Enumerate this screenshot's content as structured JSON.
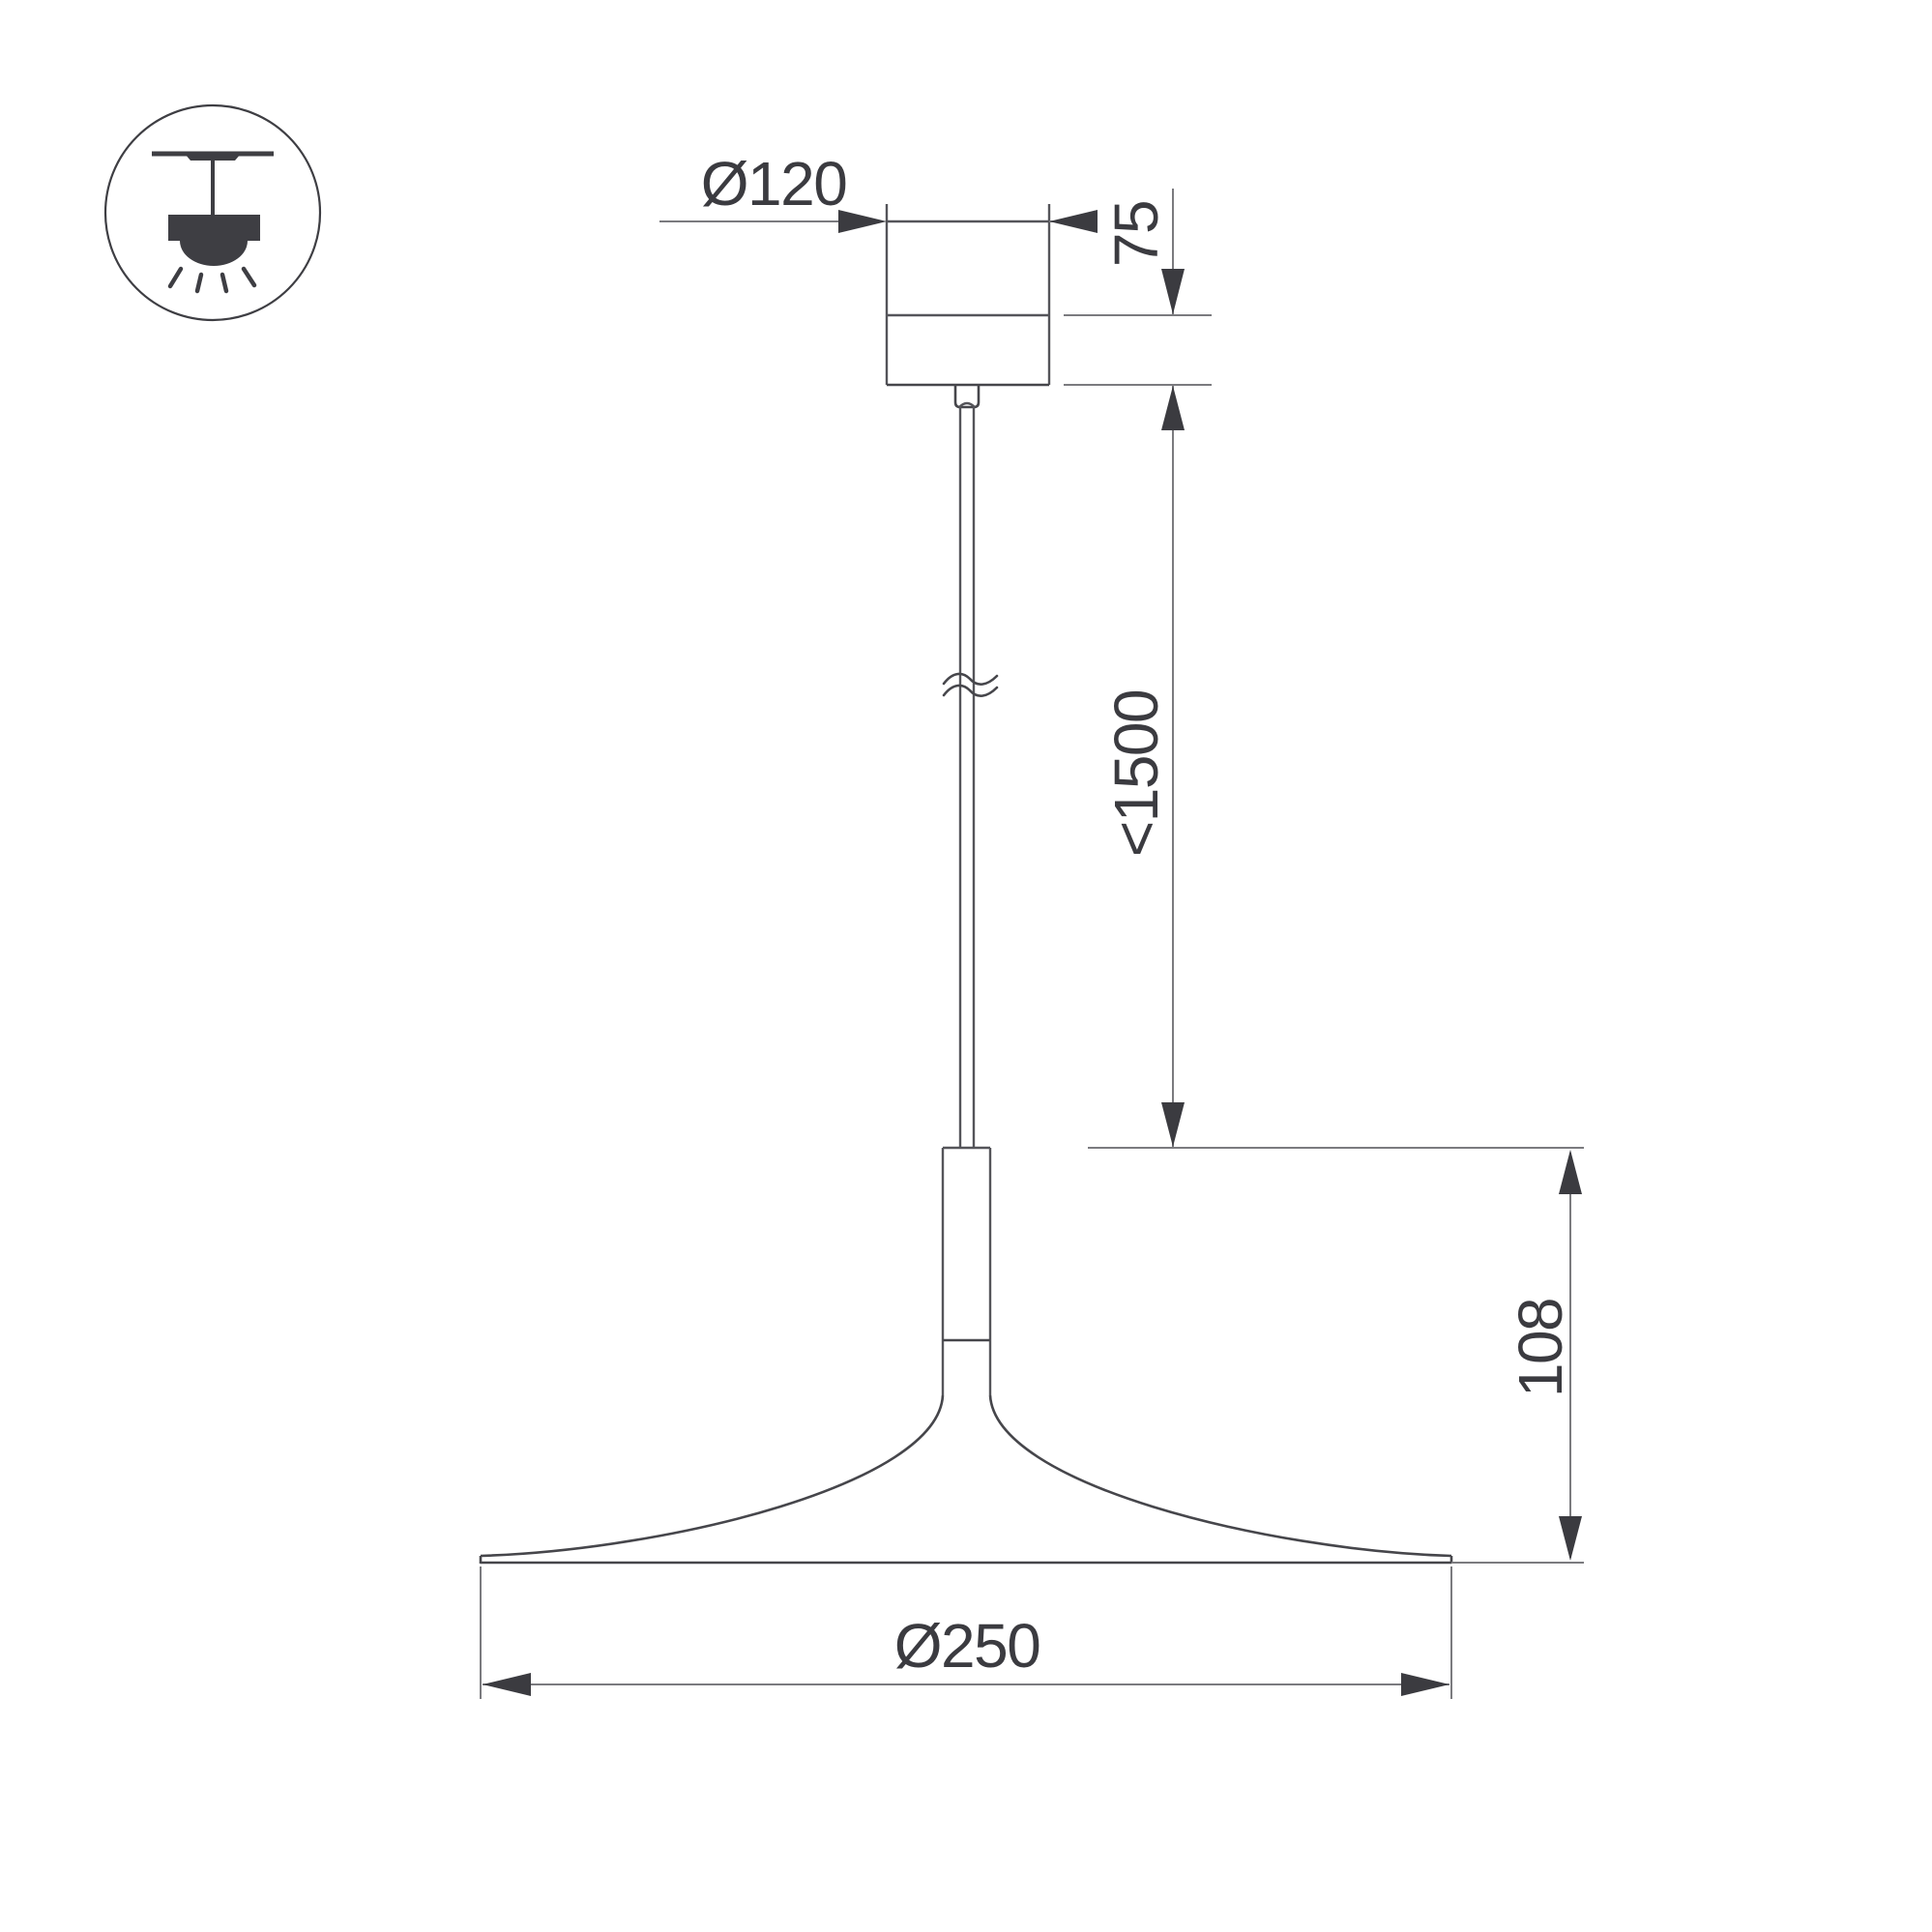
{
  "drawing": {
    "type": "technical-dimension-drawing",
    "subject": "pendant lamp with canopy, suspension cable and flat cone shade",
    "dimensions": {
      "canopy_diameter": {
        "label": "Ø120",
        "value": 120
      },
      "canopy_height": {
        "label": "75",
        "value": 75
      },
      "suspension_length": {
        "label": "<1500",
        "value": 1500
      },
      "shade_height": {
        "label": "108",
        "value": 108
      },
      "shade_diameter": {
        "label": "Ø250",
        "value": 250
      }
    }
  },
  "legend_icon": {
    "name": "ceiling-pendant-mount-icon",
    "description": "circled pictogram of a lamp hanging from ceiling with light rays"
  },
  "colors": {
    "background": "#ffffff",
    "object_line": "#55555a",
    "dimension_line": "#7b7b7f",
    "arrow_and_text": "#3b3b40",
    "icon": "#3e3e43"
  }
}
